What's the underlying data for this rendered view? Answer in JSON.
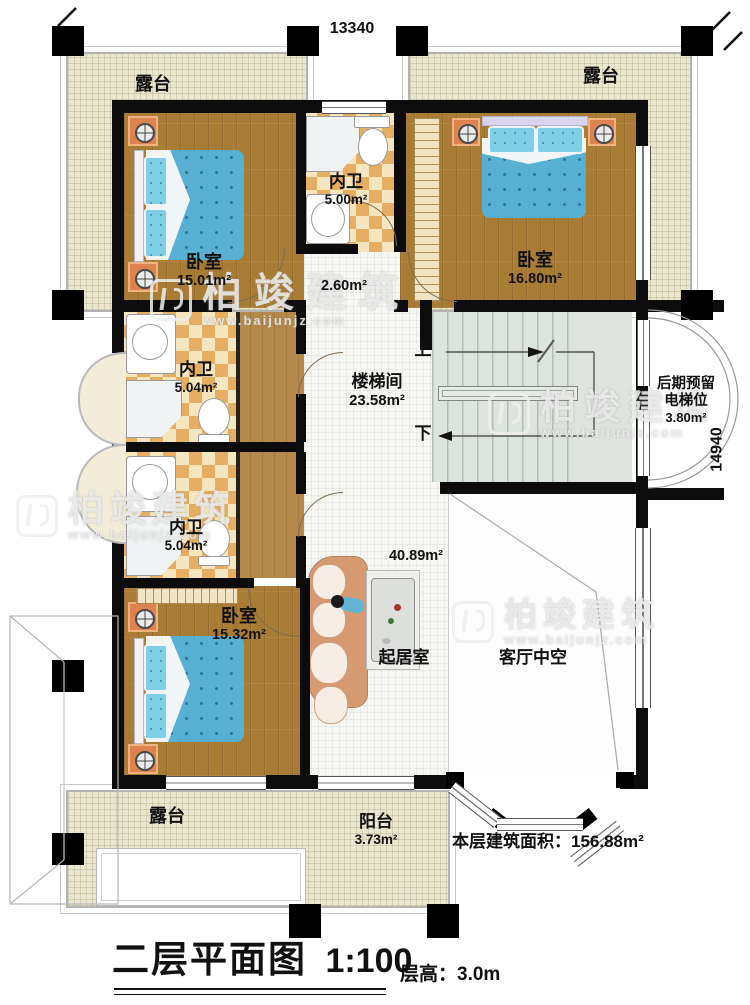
{
  "dims": {
    "top": "13340",
    "right": "14940"
  },
  "rooms": {
    "terrace_tl": {
      "name": "露台"
    },
    "terrace_tr": {
      "name": "露台"
    },
    "terrace_bl": {
      "name": "露台"
    },
    "balcony": {
      "name": "阳台",
      "area": "3.73m²"
    },
    "bedroom_tl": {
      "name": "卧室",
      "area": "15.01m²"
    },
    "bedroom_tr": {
      "name": "卧室",
      "area": "16.80m²"
    },
    "bedroom_b": {
      "name": "卧室",
      "area": "15.32m²"
    },
    "bath_top": {
      "name": "内卫",
      "area": "5.00m²"
    },
    "bath_mid": {
      "name": "内卫",
      "area": "5.04m²"
    },
    "bath_low": {
      "name": "内卫",
      "area": "5.04m²"
    },
    "hall": {
      "area": "2.60m²"
    },
    "stairwell": {
      "name": "楼梯间",
      "area": "23.58m²",
      "up": "上",
      "down": "下"
    },
    "living": {
      "name": "起居室",
      "area": "40.89m²"
    },
    "void": {
      "name": "客厅中空"
    },
    "elevator": {
      "name_line1": "后期预留",
      "name_line2": "电梯位",
      "area": "3.80m²"
    }
  },
  "notes": {
    "floor_area_label": "本层建筑面积：",
    "floor_area_value": "156.88m²"
  },
  "title": {
    "name": "二层平面图",
    "scale": "1:100",
    "floor_height": "层高：3.0m"
  },
  "watermark": {
    "brand": "柏竣建筑",
    "url": "www.baijunjz.com"
  }
}
